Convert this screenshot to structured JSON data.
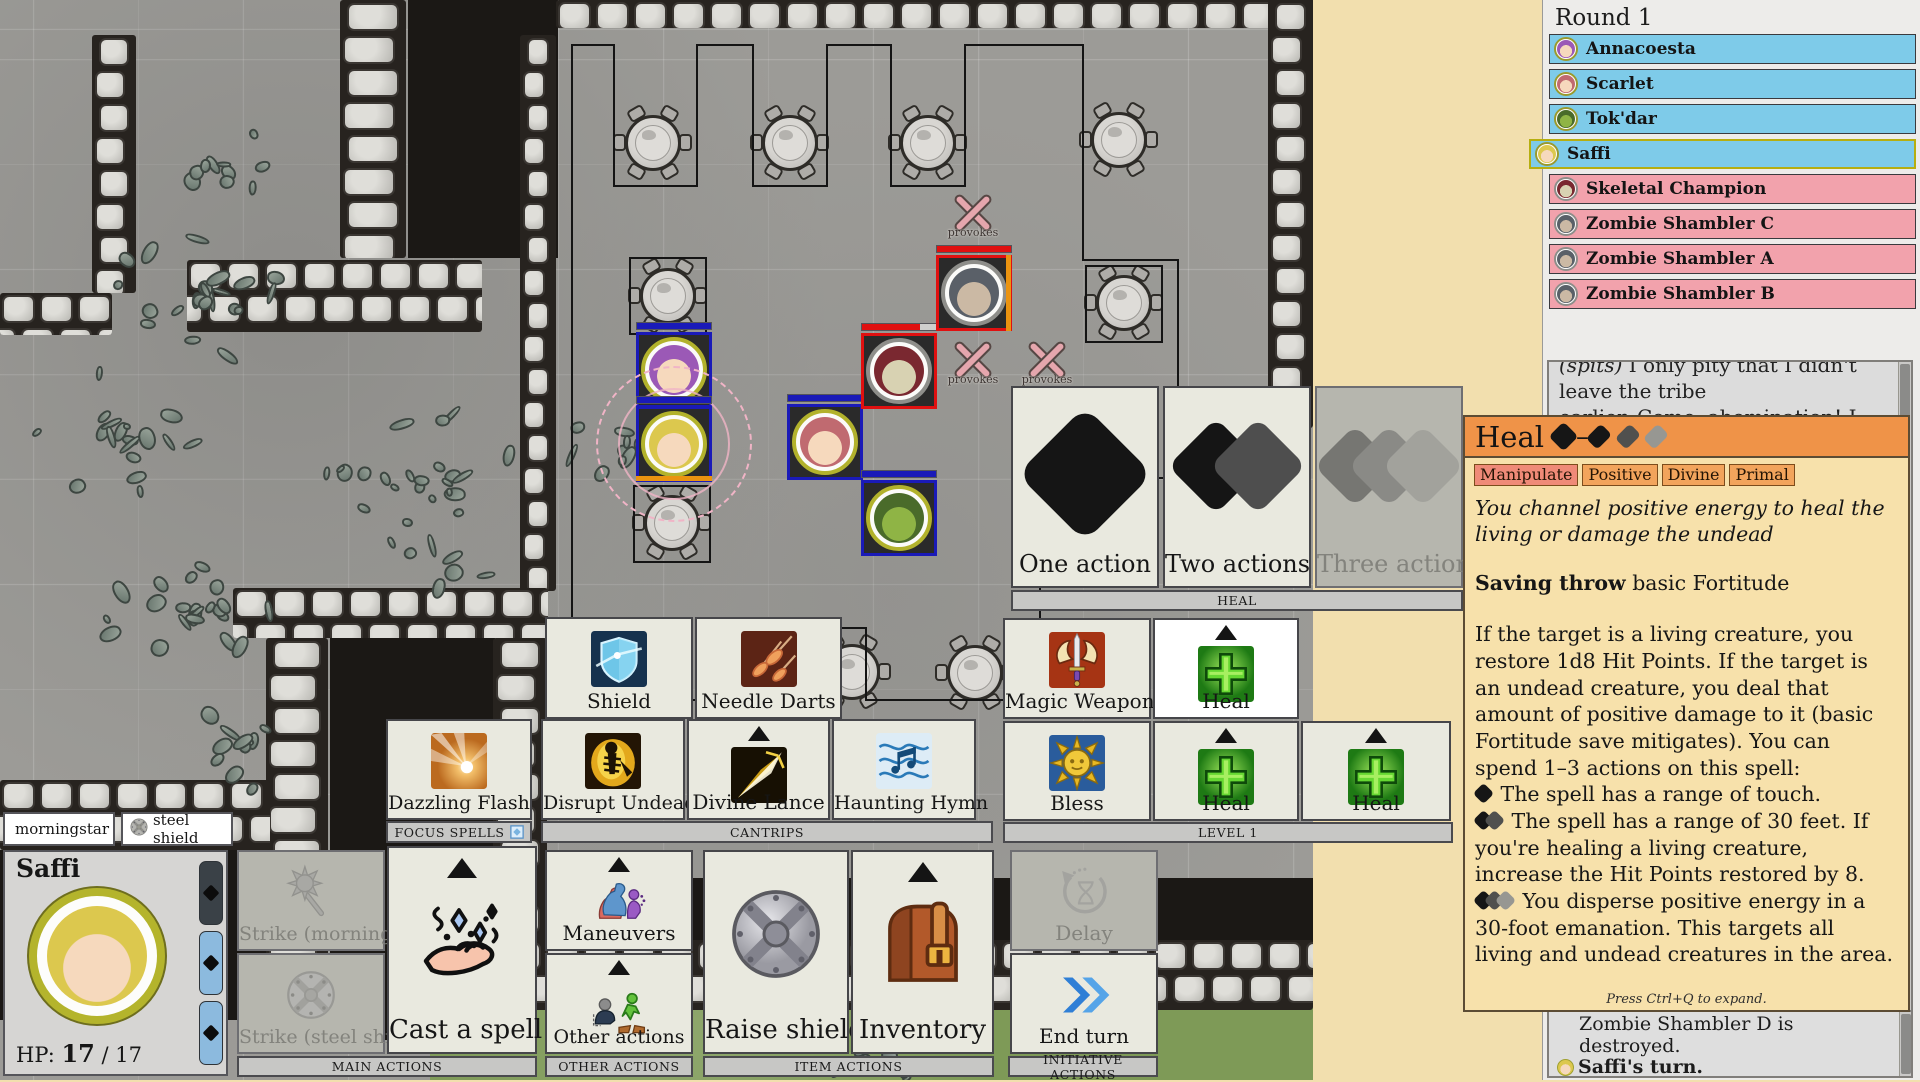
{
  "palette": {
    "ally_blue": "#7ecbe9",
    "enemy_pink": "#f2a2ac",
    "active_border": "#b6ae10",
    "heal_header_orange": "#ef9348",
    "panel_tan": "#f7e1ab",
    "trait_orange": "#f2a45c",
    "trait_red": "#ef8a78",
    "hp_blue": "#1a1ab8",
    "hp_red": "#e01010",
    "grass_green": "#7e9a57"
  },
  "initiative": {
    "round_label": "Round 1",
    "rows": [
      {
        "name": "Annacoesta",
        "team": "ally",
        "active": false,
        "skin": "#f6d9bd",
        "hair": "#9b59b6"
      },
      {
        "name": "Scarlet",
        "team": "ally",
        "active": false,
        "skin": "#f6d9bd",
        "hair": "#c06a70"
      },
      {
        "name": "Tok'dar",
        "team": "ally",
        "active": false,
        "skin": "#8fb445",
        "hair": "#4a6b2a"
      },
      {
        "name": "Saffi",
        "team": "ally",
        "active": true,
        "skin": "#f6d9bd",
        "hair": "#dcc84e"
      },
      {
        "name": "Skeletal Champion",
        "team": "enemy",
        "active": false,
        "skin": "#d8d2b2",
        "hair": "#7a2830"
      },
      {
        "name": "Zombie Shambler C",
        "team": "enemy",
        "active": false,
        "skin": "#cbb9a4",
        "hair": "#5a6068"
      },
      {
        "name": "Zombie Shambler A",
        "team": "enemy",
        "active": false,
        "skin": "#cbb9a4",
        "hair": "#5a6068"
      },
      {
        "name": "Zombie Shambler B",
        "team": "enemy",
        "active": false,
        "skin": "#cbb9a4",
        "hair": "#5a6068"
      }
    ]
  },
  "dialog": {
    "line1_em": "(spits)",
    "line1": " I only pity that I didn't leave the tribe",
    "line2": "earlier. Come, abomination! I will lay you to"
  },
  "combat_log": {
    "lines": [
      {
        "text": "Zombie Shambler D is destroyed.",
        "indent": true
      },
      {
        "icon": "saffi",
        "bold": "Saffi's turn."
      },
      {
        "pre": "Saffi uses ",
        "bold": "Stride",
        "post": "."
      }
    ]
  },
  "heal_card": {
    "title": "Heal",
    "action_cost_dash": "–",
    "traits": [
      {
        "label": "Manipulate",
        "variant": "red"
      },
      {
        "label": "Positive",
        "variant": "orange"
      },
      {
        "label": "Divine",
        "variant": "orange"
      },
      {
        "label": "Primal",
        "variant": "orange"
      }
    ],
    "flavor": "You channel positive energy to heal the living or damage the undead",
    "saving_throw_label": "Saving throw",
    "saving_throw_value": " basic Fortitude",
    "body_intro": "If the target is a living creature, you restore 1d8 Hit Points. If the target is an undead creature, you deal that amount of positive damage to it (basic Fortitude save mitigates). You can spend 1–3 actions on this spell:",
    "bullets": [
      {
        "actions": 1,
        "text": " The spell has a range of touch."
      },
      {
        "actions": 2,
        "text": " The spell has a range of 30 feet. If you're healing a living creature, increase the Hit Points restored by 8."
      },
      {
        "actions": 3,
        "text": " You disperse positive energy in a 30-foot emanation. This targets all living and undead creatures in the area."
      }
    ],
    "footer": "Press Ctrl+Q to expand."
  },
  "action_picker": {
    "caption": "HEAL",
    "options": [
      {
        "label": "One action",
        "actions": 1,
        "enabled": true,
        "x": 1011,
        "y": 386,
        "w": 148,
        "h": 202
      },
      {
        "label": "Two actions",
        "actions": 2,
        "enabled": true,
        "x": 1163,
        "y": 386,
        "w": 148,
        "h": 202
      },
      {
        "label": "Three actions",
        "actions": 3,
        "enabled": false,
        "x": 1315,
        "y": 386,
        "w": 148,
        "h": 202
      }
    ],
    "caption_bar": {
      "x": 1011,
      "y": 590,
      "w": 452,
      "h": 21
    }
  },
  "character": {
    "name": "Saffi",
    "hp_label": "HP:",
    "hp_current": "17",
    "hp_max": " / 17",
    "skin": "#f6d9bd",
    "hair": "#dcc84e",
    "weapons": [
      {
        "label": "morningstar",
        "icon": "morningstar",
        "x": 3,
        "w": 112
      },
      {
        "label": "steel shield",
        "icon": "shield_round",
        "x": 121,
        "w": 112
      }
    ],
    "action_pips": [
      {
        "state": "used",
        "y": 861
      },
      {
        "state": "avail",
        "y": 931
      },
      {
        "state": "avail",
        "y": 1001
      }
    ]
  },
  "spell_cards": [
    {
      "id": "shield",
      "label": "Shield",
      "icon": "shield_spell",
      "x": 545,
      "y": 617,
      "w": 148,
      "h": 102
    },
    {
      "id": "needle-darts",
      "label": "Needle Darts",
      "icon": "needle_darts",
      "x": 695,
      "y": 617,
      "w": 147,
      "h": 102
    },
    {
      "id": "magic-weapon",
      "label": "Magic Weapon",
      "icon": "magic_weapon",
      "x": 1003,
      "y": 618,
      "w": 148,
      "h": 101
    },
    {
      "id": "heal-selected",
      "label": "Heal",
      "icon": "heal_spell",
      "x": 1153,
      "y": 618,
      "w": 146,
      "h": 101,
      "selected": true,
      "expand": true
    },
    {
      "id": "dazzling-flash",
      "label": "Dazzling Flash",
      "icon": "dazzling_flash",
      "x": 386,
      "y": 719,
      "w": 146,
      "h": 101
    },
    {
      "id": "disrupt-undead",
      "label": "Disrupt Undead",
      "icon": "disrupt_undead",
      "x": 541,
      "y": 719,
      "w": 144,
      "h": 101
    },
    {
      "id": "divine-lance",
      "label": "Divine Lance",
      "icon": "divine_lance",
      "x": 687,
      "y": 719,
      "w": 143,
      "h": 101,
      "expand": true
    },
    {
      "id": "haunting-hymn",
      "label": "Haunting Hymn",
      "icon": "haunting_hymn",
      "x": 832,
      "y": 719,
      "w": 144,
      "h": 101
    },
    {
      "id": "bless",
      "label": "Bless",
      "icon": "bless",
      "x": 1003,
      "y": 721,
      "w": 148,
      "h": 100
    },
    {
      "id": "heal-1",
      "label": "Heal",
      "icon": "heal_spell",
      "x": 1153,
      "y": 721,
      "w": 146,
      "h": 100,
      "expand": true
    },
    {
      "id": "heal-2",
      "label": "Heal",
      "icon": "heal_spell",
      "x": 1301,
      "y": 721,
      "w": 150,
      "h": 100,
      "expand": true
    }
  ],
  "action_cards": [
    {
      "id": "strike-morningstar",
      "label": "Strike (morningstar)",
      "icon": "morningstar",
      "x": 237,
      "y": 850,
      "w": 148,
      "h": 101,
      "disabled": true
    },
    {
      "id": "strike-steel-shield",
      "label": "Strike (steel shield)",
      "icon": "shield_round",
      "x": 237,
      "y": 953,
      "w": 148,
      "h": 101,
      "disabled": true
    },
    {
      "id": "cast-a-spell",
      "label": "Cast a spell",
      "icon": "cast_spell",
      "x": 387,
      "y": 846,
      "w": 150,
      "h": 208,
      "big": true,
      "expand": true
    },
    {
      "id": "maneuvers",
      "label": "Maneuvers",
      "icon": "maneuvers",
      "x": 545,
      "y": 850,
      "w": 148,
      "h": 101,
      "expand": true
    },
    {
      "id": "other-actions",
      "label": "Other actions",
      "icon": "other_actions",
      "x": 545,
      "y": 953,
      "w": 148,
      "h": 101,
      "expand": true
    },
    {
      "id": "raise-shield",
      "label": "Raise shield",
      "icon": "raise_shield",
      "x": 703,
      "y": 850,
      "w": 146,
      "h": 204,
      "big": true
    },
    {
      "id": "inventory",
      "label": "Inventory",
      "icon": "inventory",
      "x": 851,
      "y": 850,
      "w": 143,
      "h": 204,
      "big": true,
      "expand": true
    },
    {
      "id": "delay",
      "label": "Delay",
      "icon": "delay",
      "x": 1010,
      "y": 850,
      "w": 148,
      "h": 101,
      "disabled": true
    },
    {
      "id": "end-turn",
      "label": "End turn",
      "icon": "end_turn",
      "x": 1010,
      "y": 953,
      "w": 148,
      "h": 101
    }
  ],
  "group_bars": [
    {
      "label": "FOCUS SPELLS",
      "x": 386,
      "y": 821,
      "w": 146,
      "h": 22,
      "focus_icon": true
    },
    {
      "label": "CANTRIPS",
      "x": 541,
      "y": 821,
      "w": 452,
      "h": 22
    },
    {
      "label": "LEVEL 1",
      "x": 1003,
      "y": 822,
      "w": 450,
      "h": 21
    },
    {
      "label": "MAIN ACTIONS",
      "x": 237,
      "y": 1056,
      "w": 300,
      "h": 21
    },
    {
      "label": "OTHER ACTIONS",
      "x": 545,
      "y": 1056,
      "w": 148,
      "h": 21
    },
    {
      "label": "ITEM ACTIONS",
      "x": 703,
      "y": 1056,
      "w": 291,
      "h": 21
    },
    {
      "label": "INITIATIVE ACTIONS",
      "x": 1008,
      "y": 1056,
      "w": 150,
      "h": 21
    }
  ],
  "map": {
    "provoke_label": "provokes",
    "dark_rooms": [
      {
        "x": 408,
        "y": 0,
        "w": 150,
        "h": 258
      },
      {
        "x": 330,
        "y": 638,
        "w": 165,
        "h": 402
      },
      {
        "x": 430,
        "y": 878,
        "w": 883,
        "h": 64
      },
      {
        "x": 0,
        "y": 850,
        "w": 270,
        "h": 170
      }
    ],
    "grass": [
      {
        "x": 430,
        "y": 1008,
        "w": 883,
        "h": 72
      }
    ],
    "walls": [
      {
        "x": 556,
        "y": 0,
        "w": 778,
        "h": 28
      },
      {
        "x": 340,
        "y": 0,
        "w": 66,
        "h": 258
      },
      {
        "x": 1268,
        "y": 0,
        "w": 45,
        "h": 428
      },
      {
        "x": 92,
        "y": 35,
        "w": 44,
        "h": 258
      },
      {
        "x": 0,
        "y": 293,
        "w": 112,
        "h": 42
      },
      {
        "x": 187,
        "y": 260,
        "w": 295,
        "h": 72
      },
      {
        "x": 520,
        "y": 35,
        "w": 36,
        "h": 556
      },
      {
        "x": 233,
        "y": 588,
        "w": 315,
        "h": 50
      },
      {
        "x": 266,
        "y": 638,
        "w": 62,
        "h": 402
      },
      {
        "x": 493,
        "y": 638,
        "w": 54,
        "h": 372
      },
      {
        "x": 430,
        "y": 940,
        "w": 883,
        "h": 70
      },
      {
        "x": 0,
        "y": 780,
        "w": 270,
        "h": 70
      }
    ],
    "rubble": [
      {
        "x": 215,
        "y": 160,
        "r": 55,
        "n": 10
      },
      {
        "x": 205,
        "y": 290,
        "r": 90,
        "n": 22
      },
      {
        "x": 115,
        "y": 435,
        "r": 80,
        "n": 18
      },
      {
        "x": 195,
        "y": 615,
        "r": 95,
        "n": 22
      },
      {
        "x": 430,
        "y": 500,
        "r": 115,
        "n": 30
      },
      {
        "x": 625,
        "y": 450,
        "r": 60,
        "n": 12
      },
      {
        "x": 245,
        "y": 748,
        "r": 55,
        "n": 12
      },
      {
        "x": 890,
        "y": 1056,
        "r": 60,
        "n": 10
      }
    ],
    "tables": [
      {
        "x": 653,
        "y": 143
      },
      {
        "x": 790,
        "y": 143
      },
      {
        "x": 928,
        "y": 143
      },
      {
        "x": 1119,
        "y": 140
      },
      {
        "x": 1124,
        "y": 303
      },
      {
        "x": 668,
        "y": 296
      },
      {
        "x": 672,
        "y": 523
      },
      {
        "x": 852,
        "y": 672
      },
      {
        "x": 975,
        "y": 673
      }
    ],
    "outline_path": "M572,45 L614,45 L614,186 L697,186 L697,45 L753,45 L753,186 L827,186 L827,45 L891,45 L891,186 L965,186 L965,45 L1083,45 L1083,260 L1178,260 L1178,478 L1104,478 L1104,560 L1040,560 L1040,700 L866,700 L866,628 L792,628 L792,700 L572,700 Z M630,258 L706,258 L706,334 L630,334 Z M634,486 L710,486 L710,562 L634,562 Z M862,334 L936,334 L936,408 L862,408 Z M937,256 L1011,256 L1011,330 L937,330 Z M1086,266 L1162,266 L1162,342 L1086,342 Z",
    "provoke_markers": [
      {
        "x": 973,
        "y": 220
      },
      {
        "x": 973,
        "y": 367
      },
      {
        "x": 1047,
        "y": 367
      }
    ],
    "tokens": [
      {
        "name": "Annacoesta",
        "cx": 674,
        "cy": 370,
        "team": "ally",
        "ring": "#b2b22c",
        "border": "#1a1ab8",
        "hp": 1,
        "hpcolor": "#1a1ab8",
        "skin": "#f6d9bd",
        "hair": "#9b59b6"
      },
      {
        "name": "Saffi",
        "cx": 674,
        "cy": 444,
        "team": "ally",
        "ring": "#b2b22c",
        "border": "#1a1ab8",
        "hp": 1,
        "hpcolor": "#1a1ab8",
        "skin": "#f6d9bd",
        "hair": "#dcc84e",
        "aura": true,
        "marker": "bottom"
      },
      {
        "name": "Scarlet",
        "cx": 825,
        "cy": 442,
        "team": "ally",
        "ring": "#b2b22c",
        "border": "#1a1ab8",
        "hp": 1,
        "hpcolor": "#1a1ab8",
        "skin": "#f6d9bd",
        "hair": "#c06a70"
      },
      {
        "name": "Tok'dar",
        "cx": 899,
        "cy": 518,
        "team": "ally",
        "ring": "#b2b22c",
        "border": "#1a1ab8",
        "hp": 1,
        "hpcolor": "#1a1ab8",
        "skin": "#8fb445",
        "hair": "#4a6b2a"
      },
      {
        "name": "Skeletal Champion",
        "cx": 899,
        "cy": 371,
        "team": "enemy",
        "ring": "#8e8e8a",
        "border": "#e01010",
        "hp": 0.78,
        "hpcolor": "#e01010",
        "skin": "#d8d2b2",
        "hair": "#7a2830"
      },
      {
        "name": "Zombie Shambler",
        "cx": 974,
        "cy": 293,
        "team": "enemy",
        "ring": "#8e8e8a",
        "border": "#e01010",
        "hp": 1,
        "hpcolor": "#e01010",
        "skin": "#cbb9a4",
        "hair": "#5a6068",
        "marker": "right"
      }
    ]
  }
}
